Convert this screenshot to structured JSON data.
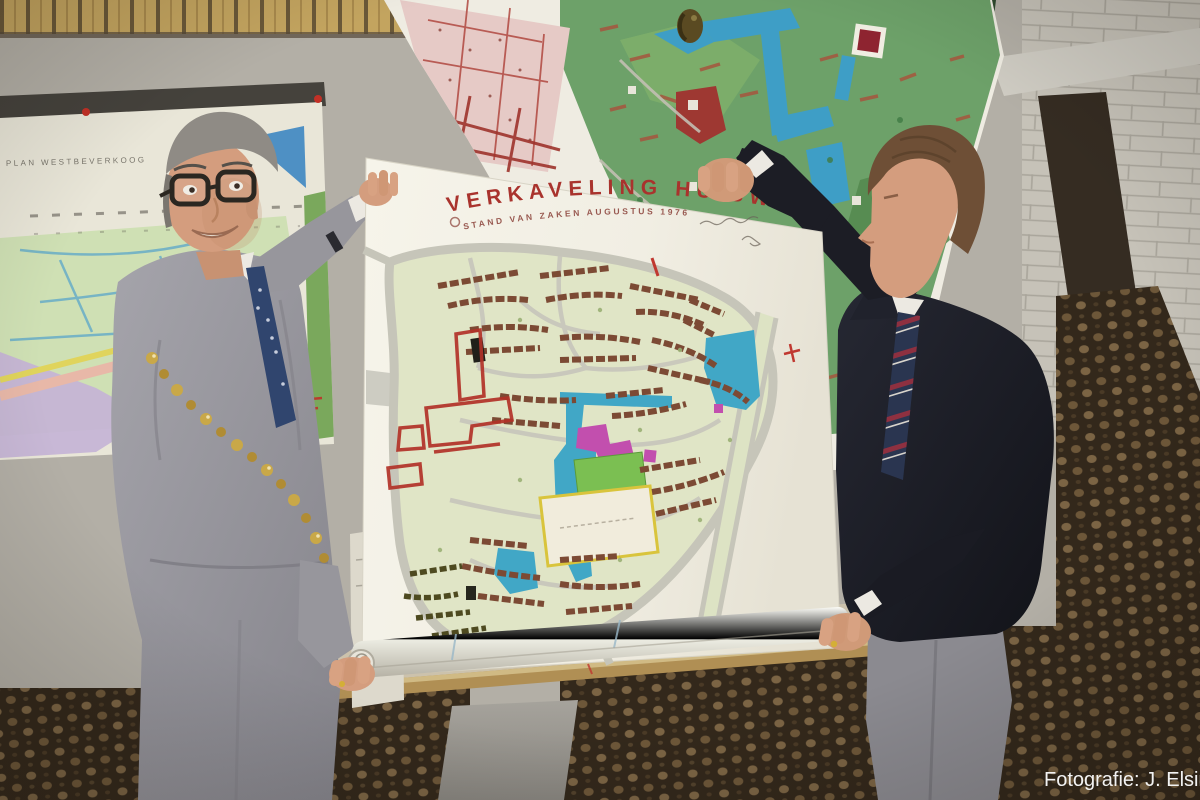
{
  "photo": {
    "credit": "Fotografie: J. Elsinga"
  },
  "main_poster": {
    "title": "VERKAVELING HUISWAARD",
    "subtitle": "STAND VAN ZAKEN AUGUSTUS 1976"
  },
  "left_wall_map": {
    "title": "PLAN WESTBEVERKOOG"
  },
  "colors": {
    "poster_title_red": "#a9332d",
    "poster_paper": "#f2efe6",
    "map_water_blue": "#41a7c6",
    "map_grass_green": "#e0e5c6",
    "map_building_brown": "#7c4a34",
    "map_special_magenta": "#c24fae",
    "sports_field_yellow": "#d9c43c",
    "carpet_brown": "#33281b",
    "wall_grey": "#b3afa6",
    "suit_grey": "#9a99a1",
    "jacket_dark": "#1d1f28",
    "chain_gold": "#c9a848",
    "credit_white": "#f2f2f2"
  }
}
